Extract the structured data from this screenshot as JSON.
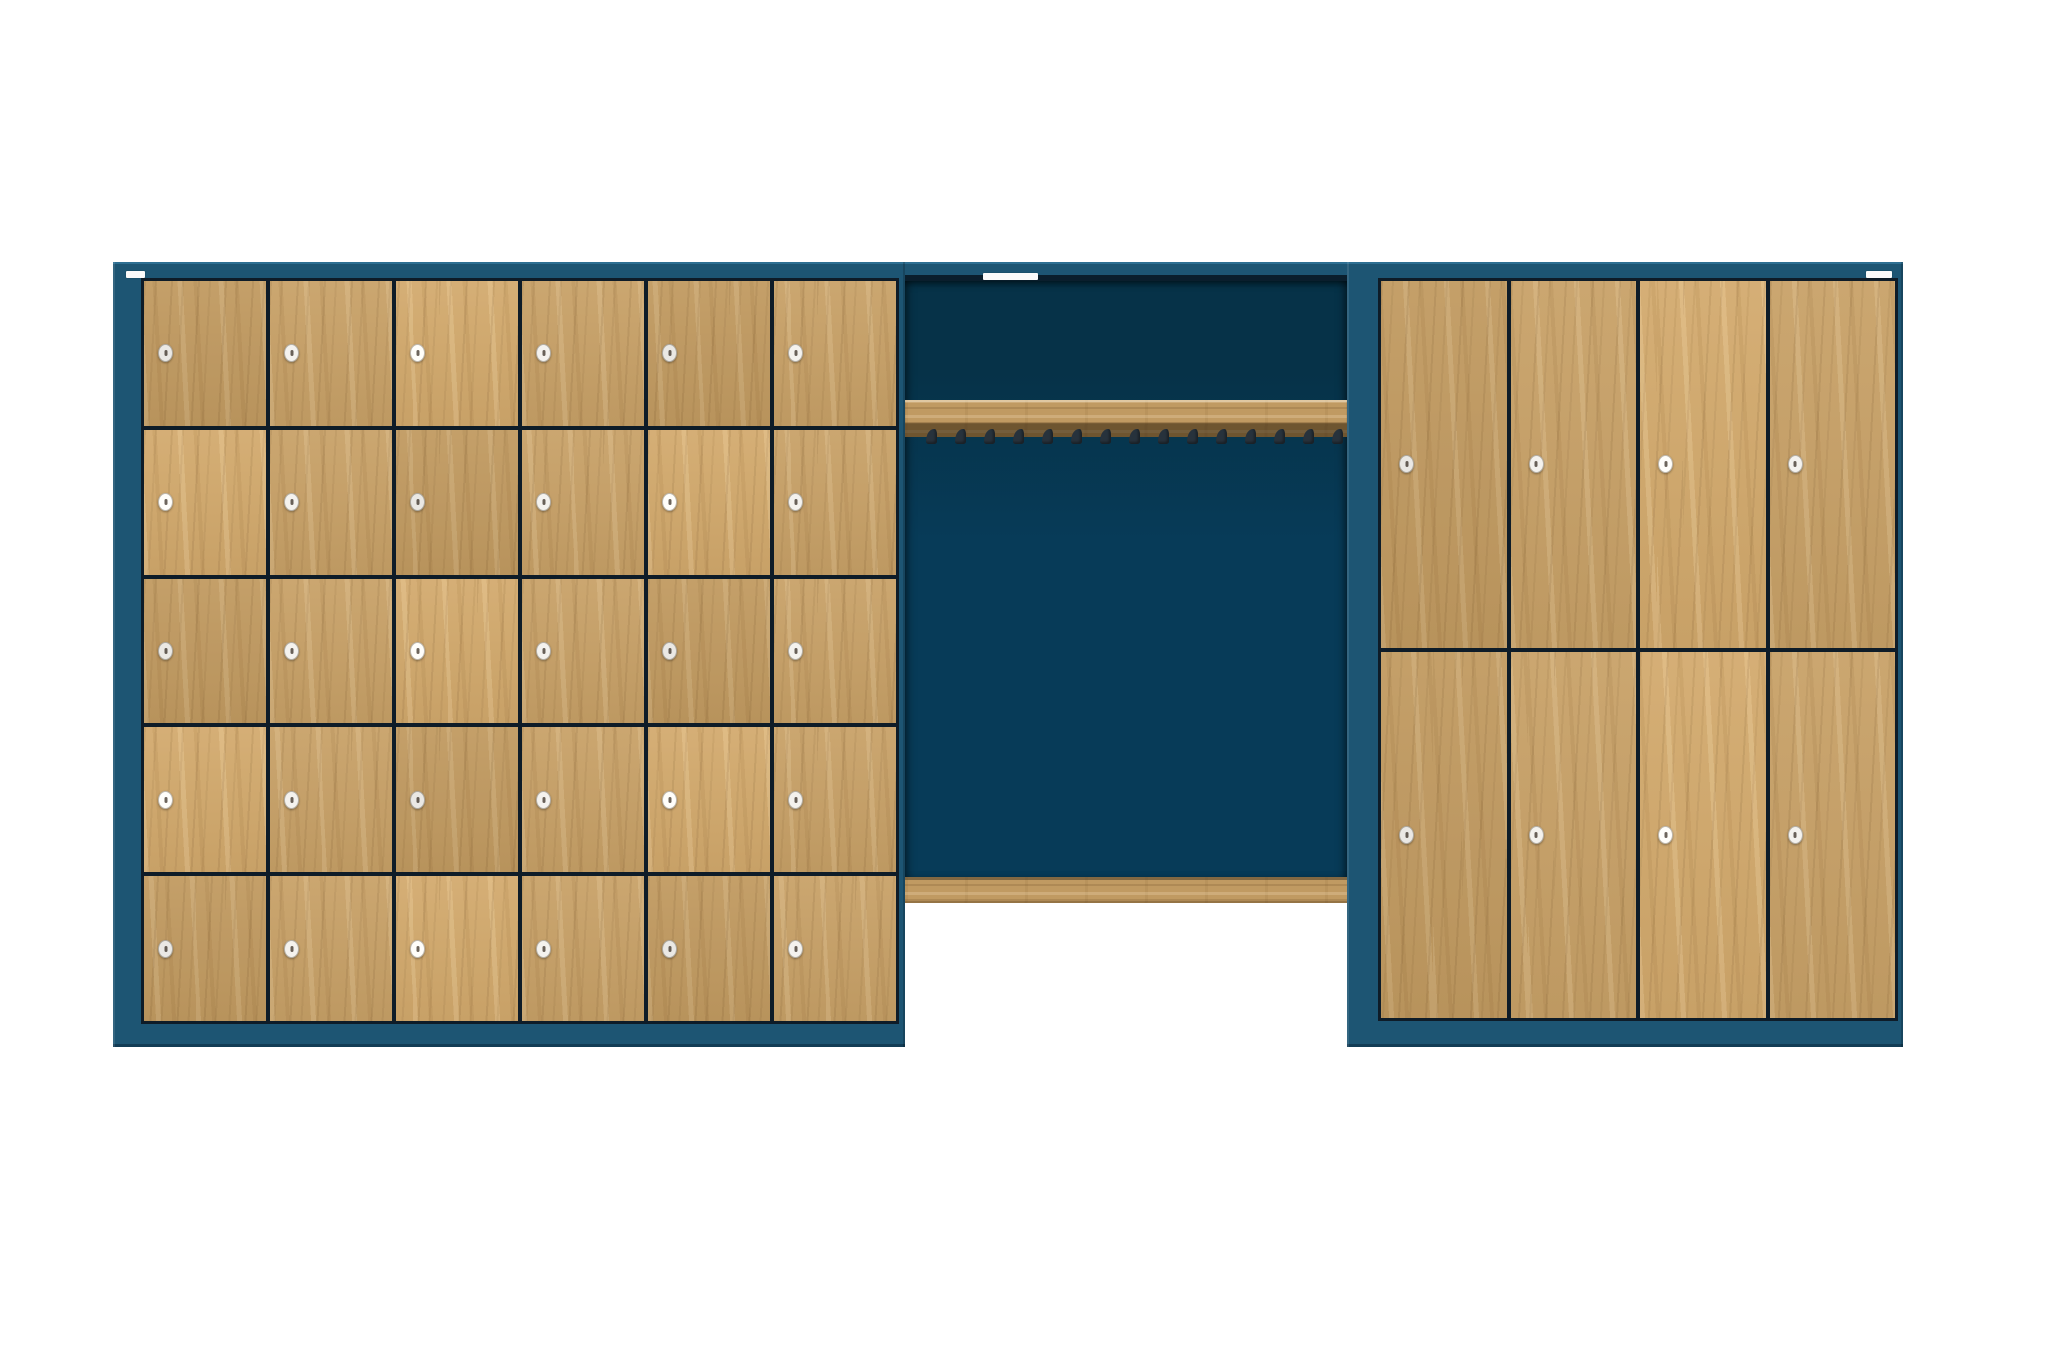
{
  "scene": {
    "description": "Front-view 3D render of a locker room wall system: blue-teal carcass with oak doors. Left: small-compartment locker unit. Middle: open cloakroom niche with coat-hook rail and bench rail over an open floor gap. Right: tall two-tier locker unit. Three blank white stickers on the top rail.",
    "background": "#ffffff",
    "colors": {
      "frame": "#1D5573",
      "frame_highlight": "#2E6F92",
      "frame_dark": "#123C55",
      "recess_shadow": "#0A1E2C",
      "panel": "#073B58",
      "panel_dark": "#063248",
      "gap_line": "#0E1C28",
      "wood": "#C8A167",
      "wood_rail": "#C09A62",
      "lock_body": "#F4F2EE",
      "lock_ring": "#B5B0A7",
      "lock_hole": "#686058",
      "hook": "#27323C",
      "label": "#FAFAFA"
    },
    "left_unit": {
      "name": "small-locker-unit",
      "x": 113,
      "y": 262,
      "w": 792,
      "h": 785,
      "doors": {
        "cols": 6,
        "rows": 5,
        "count": 30,
        "left": 28,
        "top": 16,
        "w": 752,
        "h": 740
      },
      "lock_offset_px": 14,
      "sticker": {
        "x": 126,
        "y": 271,
        "w": 19,
        "h": 7,
        "text": ""
      }
    },
    "middle_niche": {
      "name": "cloakroom-niche",
      "top_band": {
        "x": 905,
        "y": 262,
        "w": 442,
        "h": 13
      },
      "back_panel": {
        "x": 905,
        "y": 281,
        "w": 442,
        "h": 596
      },
      "coat_rail": {
        "x": 905,
        "y": 400,
        "w": 442,
        "h": 37
      },
      "hooks": {
        "count": 15,
        "x_start": 926,
        "step": 29,
        "y": 429,
        "w": 11,
        "h": 15
      },
      "bench_rail": {
        "x": 905,
        "y": 877,
        "w": 442,
        "h": 26
      },
      "sticker": {
        "x": 983,
        "y": 273,
        "w": 55,
        "h": 7,
        "text": ""
      }
    },
    "right_unit": {
      "name": "tall-locker-unit",
      "x": 1347,
      "y": 262,
      "w": 556,
      "h": 785,
      "doors": {
        "cols": 4,
        "rows": 2,
        "count": 8,
        "left": 31,
        "top": 16,
        "w": 514,
        "h": 737
      },
      "lock_offset_px": 18,
      "sticker": {
        "x": 1866,
        "y": 271,
        "w": 26,
        "h": 7,
        "text": ""
      }
    }
  }
}
